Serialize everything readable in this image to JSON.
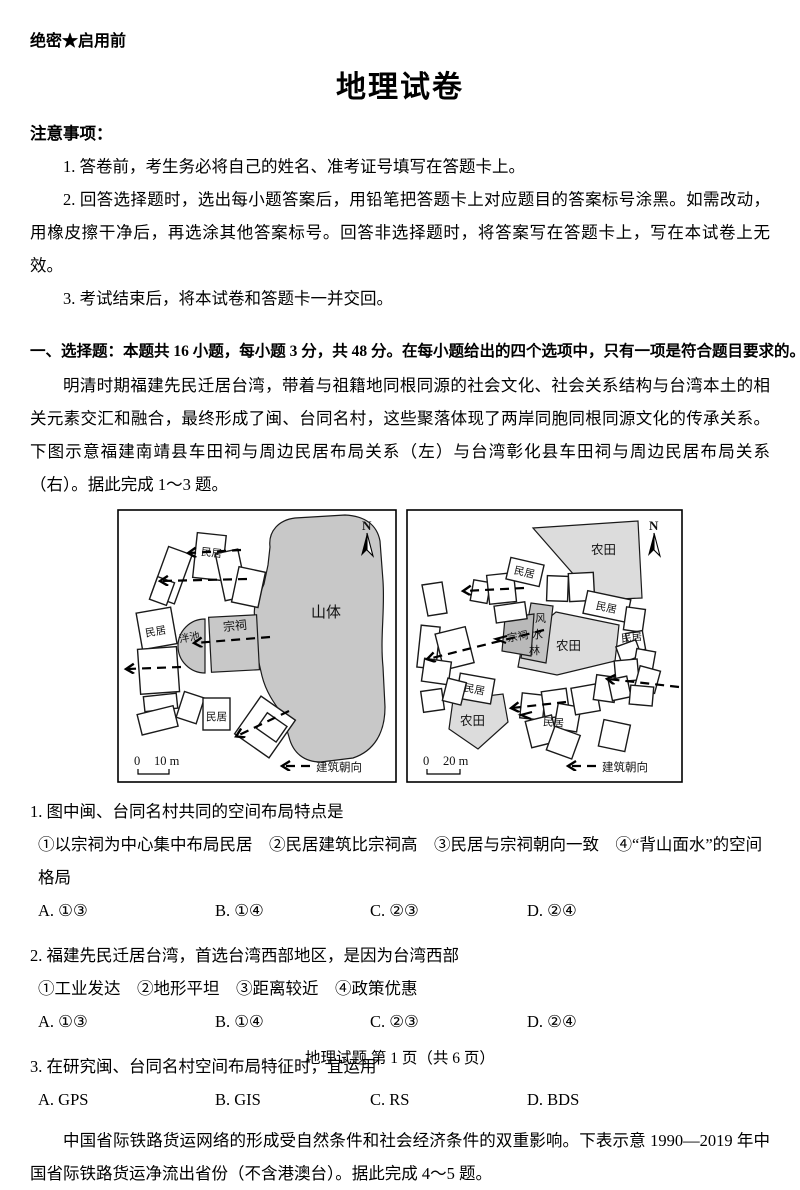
{
  "header": {
    "secrecy": "绝密★启用前",
    "title": "地理试卷",
    "notice_heading": "注意事项："
  },
  "notices": [
    "1. 答卷前，考生务必将自己的姓名、准考证号填写在答题卡上。",
    "2. 回答选择题时，选出每小题答案后，用铅笔把答题卡上对应题目的答案标号涂黑。如需改动，用橡皮擦干净后，再选涂其他答案标号。回答非选择题时，将答案写在答题卡上，写在本试卷上无效。",
    "3. 考试结束后，将本试卷和答题卡一并交回。"
  ],
  "section": {
    "heading": "一、选择题：本题共 16 小题，每小题 3 分，共 48 分。在每小题给出的四个选项中，只有一项是符合题目要求的。"
  },
  "passages": [
    "明清时期福建先民迁居台湾，带着与祖籍地同根同源的社会文化、社会关系结构与台湾本土的相关元素交汇和融合，最终形成了闽、台同名村，这些聚落体现了两岸同胞同根同源文化的传承关系。下图示意福建南靖县车田祠与周边民居布局关系（左）与台湾彰化县车田祠与周边民居布局关系（右）。据此完成 1～3 题。",
    "中国省际铁路货运网络的形成受自然条件和社会经济条件的双重影响。下表示意 1990—2019 年中国省际铁路货运净流出省份（不含港澳台）。据此完成 4～5 题。"
  ],
  "figure": {
    "colors": {
      "mountain": "#c8c8c8",
      "hall_left": "#c8c8c8",
      "pond": "#c8c8c8",
      "farmland": "#dcdcdc",
      "fengshui": "#c3c3c3",
      "hall_right": "#b9b9b9"
    },
    "left": {
      "mountain": "山体",
      "hall": "宗祠",
      "pond": "泮池",
      "residence": "民居",
      "north": "N",
      "scale_zero": "0",
      "scale_len": "10 m",
      "legend": "建筑朝向"
    },
    "right": {
      "farmland": "农田",
      "hall": "宗祠",
      "fengshui_1": "风",
      "fengshui_2": "水",
      "fengshui_3": "林",
      "residence": "民居",
      "north": "N",
      "scale_zero": "0",
      "scale_len": "20 m",
      "legend": "建筑朝向"
    }
  },
  "questions": [
    {
      "stem": "1. 图中闽、台同名村共同的空间布局特点是",
      "sub": "①以宗祠为中心集中布局民居　②民居建筑比宗祠高　③民居与宗祠朝向一致　④“背山面水”的空间格局",
      "options": [
        "A. ①③",
        "B. ①④",
        "C. ②③",
        "D. ②④"
      ]
    },
    {
      "stem": "2. 福建先民迁居台湾，首选台湾西部地区，是因为台湾西部",
      "sub": "①工业发达　②地形平坦　③距离较近　④政策优惠",
      "options": [
        "A. ①③",
        "B. ①④",
        "C. ②③",
        "D. ②④"
      ]
    },
    {
      "stem": "3. 在研究闽、台同名村空间布局特征时，宜运用",
      "options": [
        "A. GPS",
        "B. GIS",
        "C. RS",
        "D. BDS"
      ]
    }
  ],
  "footer": "地理试题 第 1 页（共 6 页）"
}
